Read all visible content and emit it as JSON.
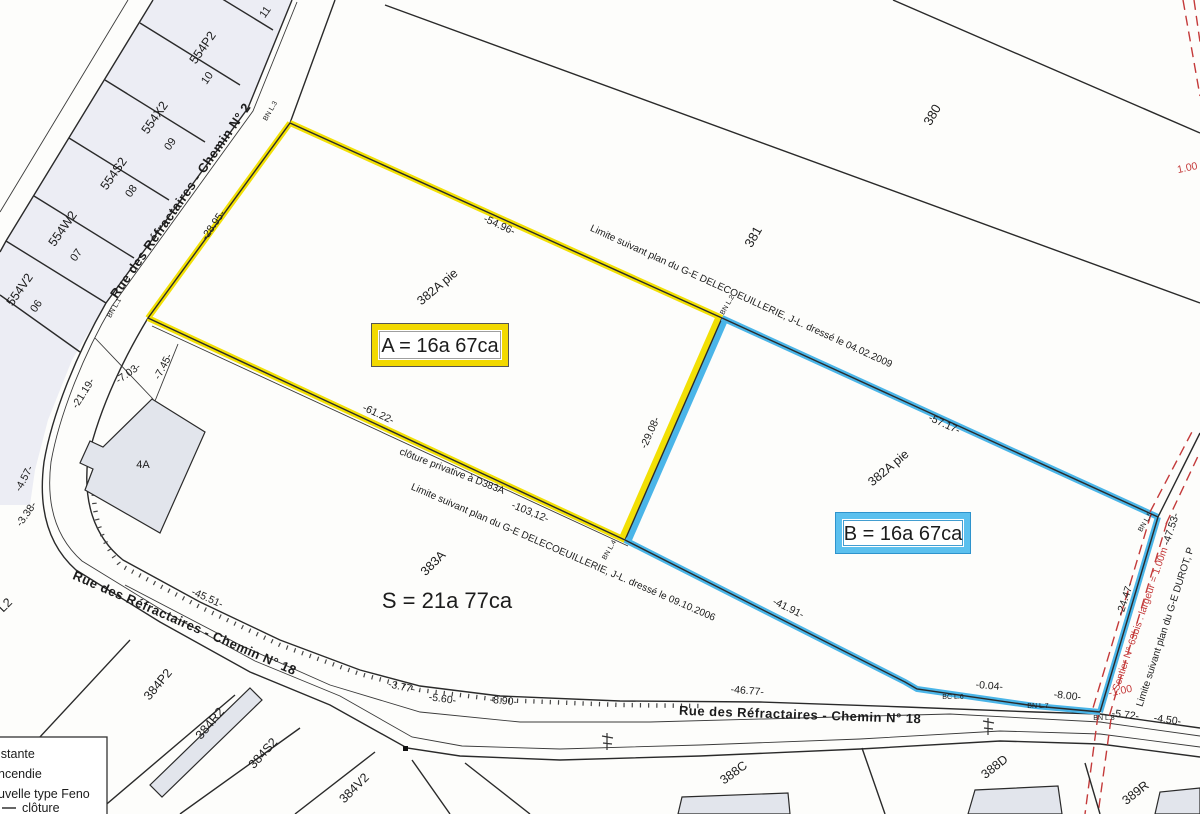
{
  "plan": {
    "area_a": "A = 16a 67ca",
    "area_b": "B = 16a 67ca",
    "area_s": "S = 21a 77ca",
    "parcels": {
      "p380": "380",
      "p381": "381",
      "p11": "11",
      "p382a_a": "382A pie",
      "p382a_b": "382A pie",
      "p383a": "383A"
    },
    "lots": [
      {
        "code": "554P2",
        "num": "10"
      },
      {
        "code": "554X2",
        "num": "09"
      },
      {
        "code": "554S2",
        "num": "08"
      },
      {
        "code": "554W2",
        "num": "07"
      },
      {
        "code": "554V2",
        "num": "06"
      }
    ],
    "south_parcels": {
      "l2": "L2",
      "p384p2": "384P2",
      "p384r2": "384R2",
      "p384s2": "384S2",
      "p384v2": "384V2",
      "p388c": "388C",
      "p388d": "388D",
      "p389r": "389R"
    },
    "building_4a": "4A",
    "roads": {
      "chemin2": "Rue des Réfractaires  -  Chemin N° 2",
      "chemin18_left": "Rue des Réfractaires  -  Chemin N° 18",
      "chemin18_main": "Rue des Réfractaires  -  Chemin N° 18"
    },
    "limits": {
      "north": "Limite suivant plan du G-E DELECOEUILLERIE, J-L. dressé le 04.02.2009",
      "south": "Limite suivant plan du G-E DELECOEUILLERIE, J-L. dressé le 09.10.2006",
      "east": "Limite suivant plan du G-E DUROT, P",
      "cloture": "clôture privative à D383A",
      "sentier": "Sentier N° 63bis : largeur = 1.00m"
    },
    "measurements": {
      "m2895": "-28.95-",
      "m5496": "-54.96-",
      "m5717": "-57.17-",
      "m4753": "-47.53-",
      "m2447": "-24.47-",
      "m2908": "-29.08-",
      "m6122": "-61.22-",
      "m10312": "-103,12-",
      "m4191": "-41.91-",
      "m4677": "-46.77-",
      "m004": "-0.04-",
      "m800": "-8.00-",
      "m572": "-5.72-",
      "m450": "-4.50-",
      "m100r": "-1.00",
      "m100t": "1.00",
      "m2119": "-21.19-",
      "m703": "-7.03-",
      "m745": "-7.45-",
      "m457": "-4.57-",
      "m338": "-3.38-",
      "m4551": "-45.51-",
      "m377": "-3.77-",
      "m560": "-5.60-",
      "m890": "-8.90-"
    },
    "markers": {
      "l1": "BN L.1",
      "l2": "BN L.2",
      "l3": "BN L.3",
      "l4": "BN L.4",
      "l5": "BN L.5",
      "l6": "BC L.6",
      "l7": "BN L.7",
      "l8": "BN L.8"
    },
    "legend": {
      "row1": "istante",
      "row2": "ncendie",
      "row3": "uvelle type Feno",
      "row4": "clôture"
    },
    "colors": {
      "parcel_a_accent": "#f2e005",
      "parcel_b_accent": "#4ab5e8",
      "sentier_red": "#c43a3a"
    }
  }
}
